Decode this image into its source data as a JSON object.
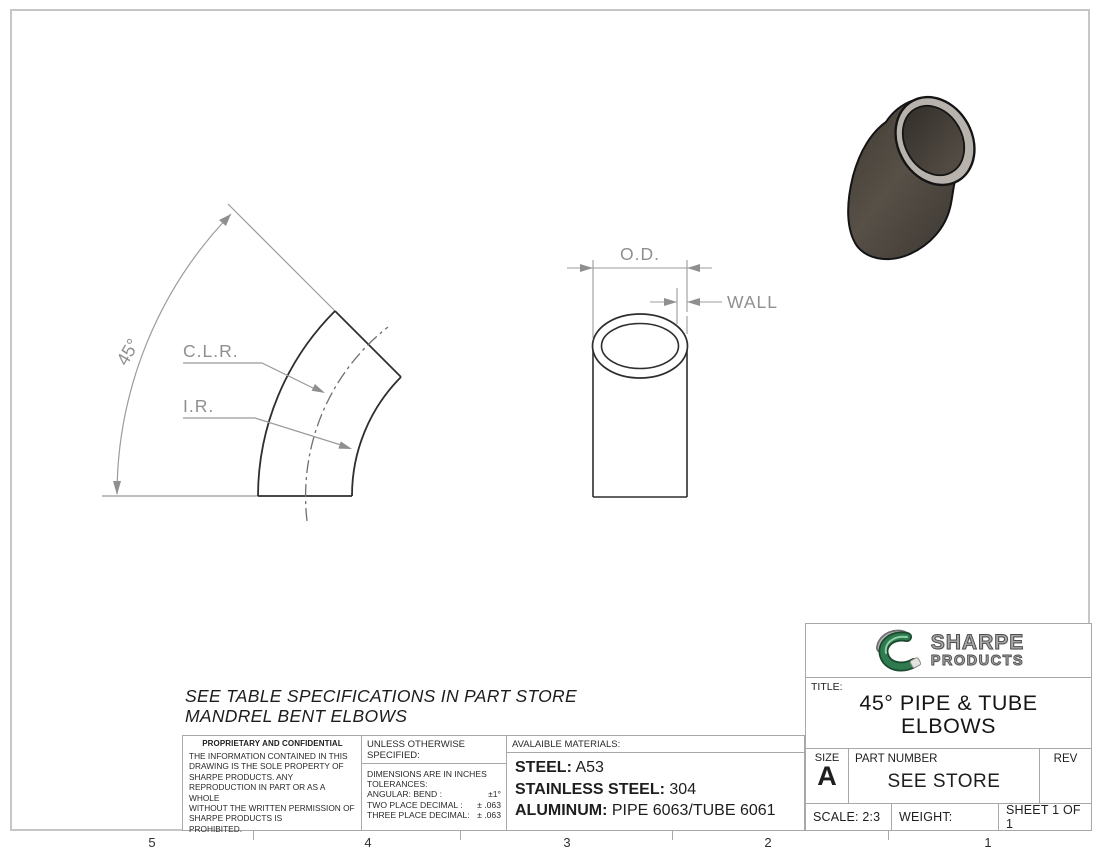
{
  "sheet": {
    "zones": [
      "5",
      "4",
      "3",
      "2",
      "1"
    ],
    "note_line1": "SEE TABLE SPECIFICATIONS IN PART STORE",
    "note_line2": "MANDREL BENT ELBOWS"
  },
  "views": {
    "elbow_view": {
      "angle_label": "45°",
      "clr_label": "C.L.R.",
      "ir_label": "I.R."
    },
    "section_view": {
      "od_label": "O.D.",
      "wall_label": "WALL"
    }
  },
  "notes_table": {
    "proprietary": {
      "title": "PROPRIETARY AND CONFIDENTIAL",
      "body": "THE INFORMATION CONTAINED IN THIS\nDRAWING IS THE SOLE PROPERTY OF\nSHARPE PRODUCTS.  ANY\nREPRODUCTION IN PART OR AS A WHOLE\nWITHOUT THE WRITTEN PERMISSION OF\nSHARPE PRODUCTS IS\nPROHIBITED."
    },
    "tolerances": {
      "title": "UNLESS OTHERWISE SPECIFIED:",
      "line1": "DIMENSIONS ARE IN INCHES",
      "line2": "TOLERANCES:",
      "rows": [
        {
          "label": "ANGULAR: BEND :",
          "value": "±1°"
        },
        {
          "label": "TWO PLACE DECIMAL  :",
          "value": "± .063"
        },
        {
          "label": "THREE PLACE DECIMAL:",
          "value": "± .063"
        }
      ]
    },
    "materials": {
      "title": "AVALAIBLE MATERIALS:",
      "rows": [
        {
          "label": "STEEL:",
          "value": "A53"
        },
        {
          "label": "STAINLESS STEEL:",
          "value": "304"
        },
        {
          "label": "ALUMINUM:",
          "value": "PIPE 6063/TUBE 6061"
        }
      ]
    }
  },
  "title_block": {
    "brand": {
      "name_top": "SHARPE",
      "name_bottom": "PRODUCTS"
    },
    "title_label": "TITLE:",
    "title_line1": "45° PIPE & TUBE",
    "title_line2": "ELBOWS",
    "size_label": "SIZE",
    "size_value": "A",
    "part_number_label": "PART NUMBER",
    "part_number_value": "SEE STORE",
    "rev_label": "REV",
    "rev_value": "",
    "scale": "SCALE: 2:3",
    "weight": "WEIGHT:",
    "sheet": "SHEET 1 OF 1"
  },
  "colors": {
    "frame_border": "#c6c6c6",
    "table_border": "#a8a8a8",
    "dimension_gray": "#8f8f8f",
    "edge_dark": "#2e2e2e",
    "logo_green": "#2f7a4e",
    "logo_silver": "#a7a7a7",
    "render_body": "#4a443c",
    "render_rim": "#b7b3ac"
  }
}
